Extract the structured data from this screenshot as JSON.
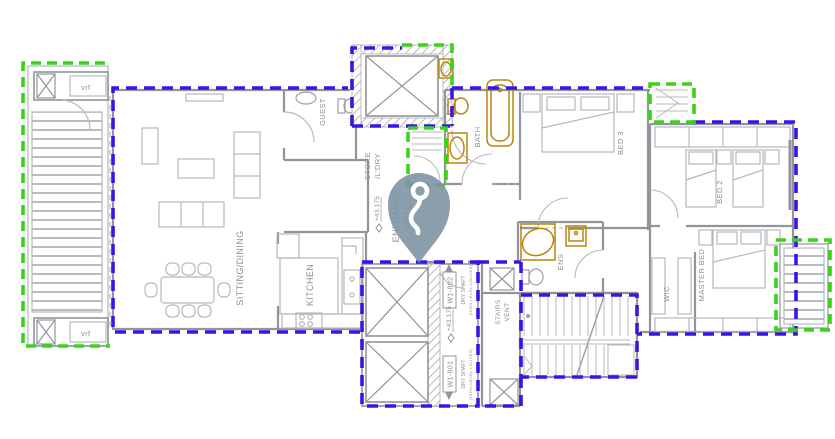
{
  "title": "Apartment floor plan with key location marker",
  "colors": {
    "unit_boundary_blue": "#3a14e6",
    "balcony_boundary_green": "#3bd318",
    "fixture_gold": "#b8860b",
    "wall_gray": "#8f959b",
    "pin_color": "#7d93a3"
  },
  "rooms": {
    "sitting_dining": "SITTING/DINING",
    "kitchen": "KITCHEN",
    "guest": "GUEST",
    "store": [
      "STORE",
      "/L'DRY"
    ],
    "bath": "BATH",
    "bed3": "BED 3",
    "bed2": "BED 2",
    "master_bed": "MASTER BED",
    "wic": "WIC",
    "ens": "ENS",
    "entrance_hall": [
      "ENTRANCE",
      "HALL"
    ],
    "stairs": [
      "STAIRS",
      "VENT"
    ]
  },
  "levels": {
    "hall_level": "+43.175",
    "shaft_level": "+43.175"
  },
  "shafts": {
    "w1_802": {
      "id": "W1-802",
      "type": "DRY SHAFT",
      "note": "[HIGH LEVEL LOUVER]"
    },
    "w1_801": {
      "id": "W1-801",
      "type": "DRY SHAFT",
      "note": "[HIGH-LEVEL LOUVER]"
    }
  },
  "equipment": {
    "vrf_top": "vrf",
    "vrf_bottom": "vrf"
  },
  "marker": {
    "name": "key-location-pin",
    "color": "#7d93a3"
  }
}
